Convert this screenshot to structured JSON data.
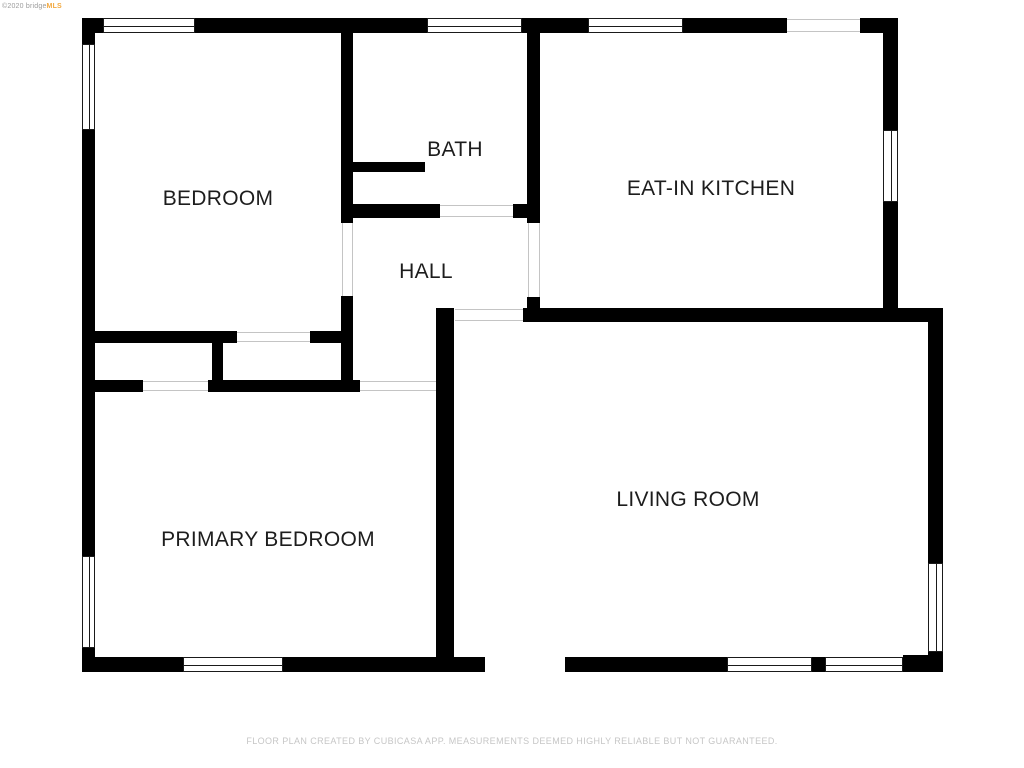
{
  "watermark": {
    "copyright": "©2020 bridge",
    "brand": "MLS"
  },
  "rooms": [
    {
      "name": "bedroom",
      "label": "BEDROOM"
    },
    {
      "name": "bath",
      "label": "BATH"
    },
    {
      "name": "eat-in-kitchen",
      "label": "EAT-IN KITCHEN"
    },
    {
      "name": "hall",
      "label": "HALL"
    },
    {
      "name": "primary-bedroom",
      "label": "PRIMARY BEDROOM"
    },
    {
      "name": "living-room",
      "label": "LIVING ROOM"
    }
  ],
  "footer": {
    "disclaimer": "FLOOR PLAN CREATED BY CUBICASA APP. MEASUREMENTS DEEMED HIGHLY RELIABLE BUT NOT GUARANTEED."
  },
  "colors": {
    "background": "#ffffff",
    "wall": "#000000",
    "label_text": "#1d1d1d",
    "footer_text": "#c6c6c6",
    "watermark_gray": "#9b9b9b",
    "watermark_orange": "#f2a83e",
    "opening_line": "#c4c4c4"
  }
}
